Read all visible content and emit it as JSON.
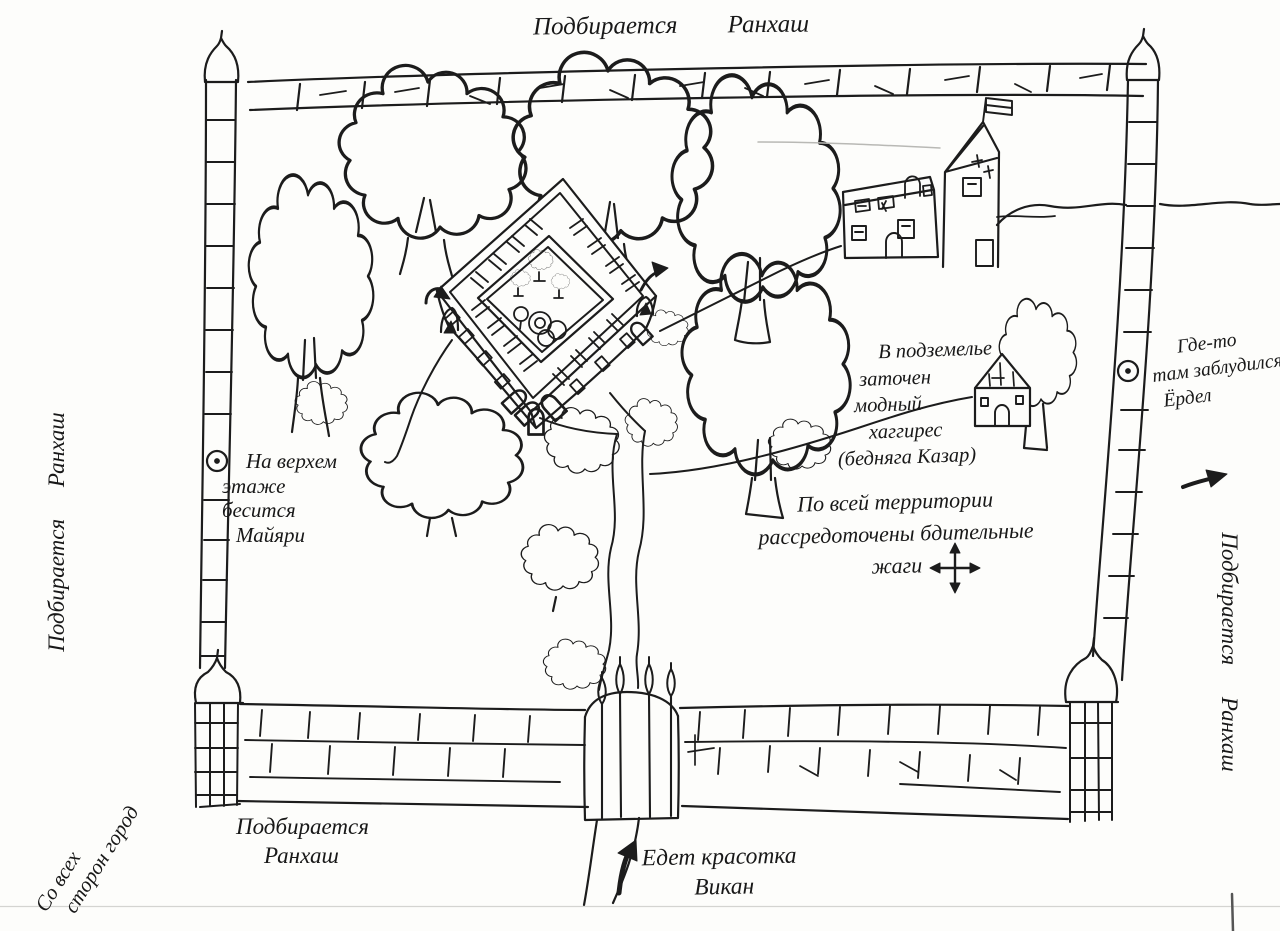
{
  "colors": {
    "ink": "#1c1c1c",
    "paper": "#fdfdfb"
  },
  "annotations": {
    "top_approach": {
      "text": "Подбирается Ранхаш"
    },
    "left_approach": {
      "text": "Подбирается Ранхаш"
    },
    "right_approach": {
      "text": "Подбирается Ранхаш"
    },
    "bottom_approach": {
      "line1": "Подбирается",
      "line2": "Ранхаш"
    },
    "corner_note": {
      "line1": "Со всех",
      "line2": "сторон город"
    },
    "maiyari_note": {
      "line1": "На верхем",
      "line2": "этаже",
      "line3": "бесится",
      "line4": "Майяри"
    },
    "dungeon_note": {
      "line1": "В подземелье",
      "line2": "заточен",
      "line3": "модный",
      "line4": "хаггирес",
      "line5": "(бедняга Казар)"
    },
    "guards_note": {
      "line1": "По всей территории",
      "line2": "рассредоточены бдительные",
      "line3": "жаги"
    },
    "lost_note": {
      "line1": "Где-то",
      "line2": "там заблудился",
      "line3": "Ёрдел"
    },
    "arrival_note": {
      "line1": "Едет красотка",
      "line2": "Викан"
    }
  },
  "icons": {
    "compass": "four-direction-arrows",
    "lost_direction": "arrow-right",
    "arrival_direction": "arrow-up",
    "castle_left_entry": "curved-arrow",
    "castle_right_entry": "curved-arrow",
    "wall_marker_left": "circle-dot",
    "wall_marker_right": "circle-dot"
  }
}
